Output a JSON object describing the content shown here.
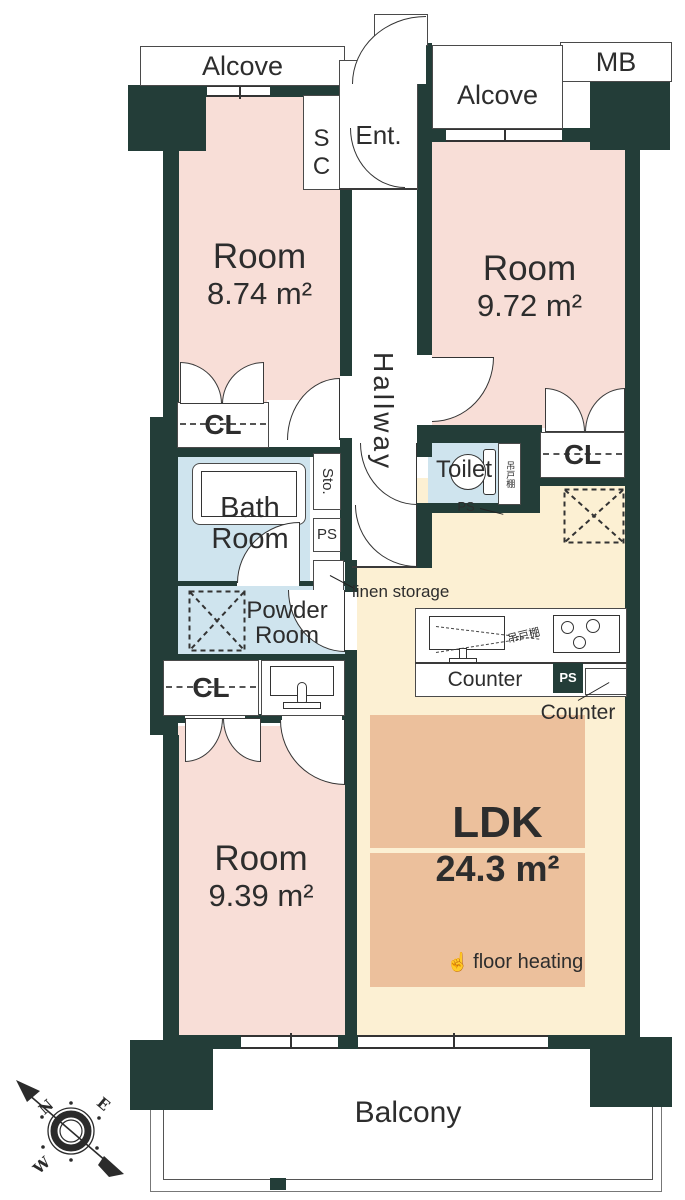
{
  "colors": {
    "wall": "#233d38",
    "room_pink": "#f8ded7",
    "ldk_beige": "#fcf0d3",
    "floor_heating_orange": "#ecc09c",
    "wet_area_blue": "#cfe4ee",
    "line_ink": "#333333"
  },
  "plan": {
    "alcove_left": "Alcove",
    "mb": "MB",
    "alcove_right": "Alcove",
    "entrance": "Ent.",
    "shoe_closet": "SC",
    "hallway": "Hallway",
    "rooms": [
      {
        "name": "Room",
        "area": "8.74 m²"
      },
      {
        "name": "Room",
        "area": "9.72 m²"
      },
      {
        "name": "Room",
        "area": "9.39 m²"
      }
    ],
    "ldk": {
      "name": "LDK",
      "area": "24.3 m²",
      "floor_heating": "floor heating",
      "hand_icon": "☝"
    },
    "closets": [
      "CL",
      "CL",
      "CL"
    ],
    "toilet": "Toilet",
    "toilet_cabinet": "吊戸棚",
    "bath": "Bath Room",
    "powder": "Powder Room",
    "storage": "Sto.",
    "linen": "linen storage",
    "ps_labels": [
      "PS",
      "PS",
      "PS"
    ],
    "kitchen": {
      "counter": "Counter",
      "counter_side": "Counter",
      "hanging_cabinet": "吊戸棚"
    },
    "balcony": "Balcony",
    "compass": {
      "n": "N",
      "e": "E",
      "w": "W"
    }
  }
}
